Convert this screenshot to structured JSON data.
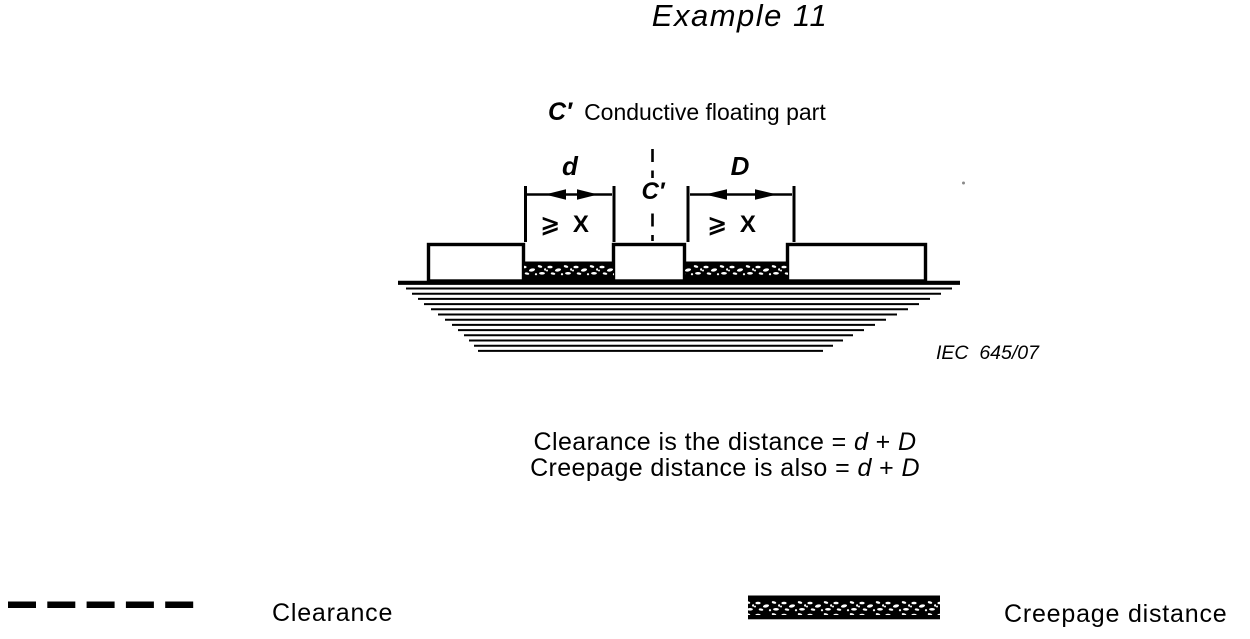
{
  "colors": {
    "ink": "#000000",
    "paper": "#ffffff"
  },
  "title": "Example 11",
  "figure": {
    "part_label_symbol": "C′",
    "part_label_text": "Conductive floating part",
    "dim_small_label": "d",
    "dim_large_label": "D",
    "centerline_label": "C′",
    "min_distance_left": "⩾ X",
    "min_distance_right": "⩾ X",
    "standard_ref": "IEC  645/07"
  },
  "caption": {
    "line1_text": "Clearance is the distance = ",
    "line1_d": "d",
    "line1_plus": " + ",
    "line1_D": "D",
    "line2_text": "Creepage distance is also = ",
    "line2_d": "d",
    "line2_plus": " + ",
    "line2_D": "D"
  },
  "legend": {
    "clearance": "Clearance",
    "creepage": "Creepage distance"
  }
}
